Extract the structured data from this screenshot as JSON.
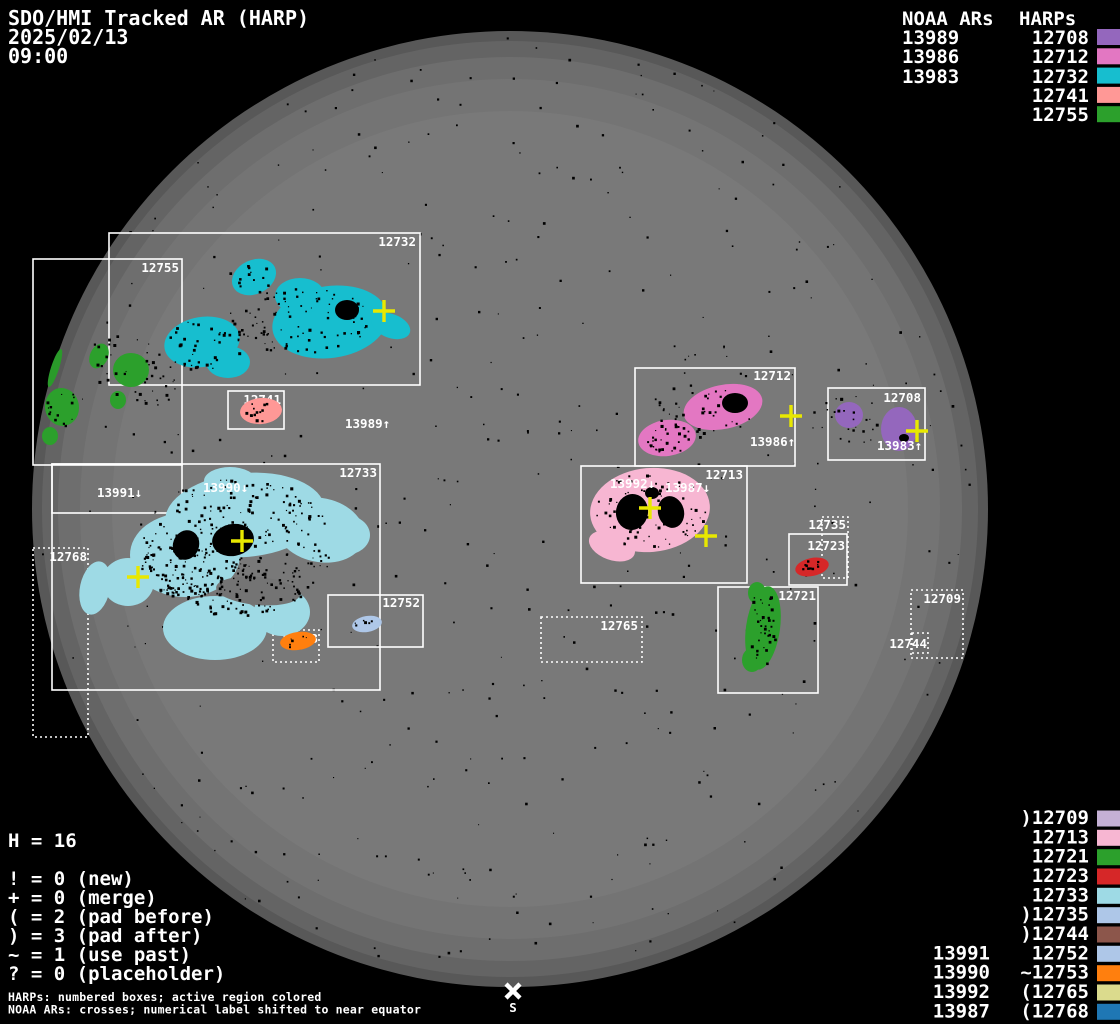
{
  "title": {
    "app": "SDO/HMI Tracked AR (HARP)",
    "date": "2025/02/13",
    "time": "09:00"
  },
  "colors": {
    "background": "#000000",
    "disk": "#757575",
    "yellow": "#e8e800",
    "white": "#ffffff"
  },
  "palette": {
    "12708": "#9467bd",
    "12712": "#e377c2",
    "12732": "#17becf",
    "12741": "#ff9896",
    "12755": "#2ca02c",
    "12709": "#c5b0d5",
    "12713": "#f7b6d2",
    "12721": "#2ca02c",
    "12723": "#d62728",
    "12733": "#9edae5",
    "12735": "#aec7e8",
    "12744": "#8c564b",
    "12752": "#aec7e8",
    "12753": "#ff7f0e",
    "12765": "#dbdb8d",
    "12768": "#1f77b4",
    "limb_green": "#2a9a2a"
  },
  "top_right": {
    "noaa_header": "NOAA ARs",
    "harps_header": "HARPs",
    "noaa": [
      "13989",
      "13986",
      "13983"
    ],
    "harps": [
      "12708",
      "12712",
      "12732",
      "12741",
      "12755"
    ]
  },
  "bottom_right": {
    "harps": [
      ")12709",
      "12713",
      "12721",
      "12723",
      "12733",
      ")12735",
      ")12744",
      "12752",
      "~12753",
      "(12765",
      "(12768"
    ],
    "noaa": [
      "13991",
      "13990",
      "13992",
      "13987"
    ]
  },
  "stats": {
    "h_count": "H = 16",
    "flags": [
      "! = 0 (new)",
      "+ = 0 (merge)",
      "( = 2 (pad before)",
      ") = 3 (pad after)",
      "~ = 1 (use past)",
      "? = 0 (placeholder)"
    ]
  },
  "footer": {
    "line1": "HARPs: numbered boxes; active region colored",
    "line2": "NOAA ARs: crosses; numerical label shifted to near equator"
  },
  "box_labels": {
    "12708": "12708",
    "12709": "12709",
    "12712": "12712",
    "12713": "12713",
    "12721": "12721",
    "12723": "12723",
    "12732": "12732",
    "12733": "12733",
    "12735": "12735",
    "12741": "12741",
    "12744": "12744",
    "12752": "12752",
    "12753": "12753",
    "12755": "12755",
    "12765": "12765",
    "12768": "12768"
  },
  "noaa_disk_labels": {
    "13989": "13989↑",
    "13986": "13986↑",
    "13983": "13983↑",
    "13991": "13991↓",
    "13990": "13990↓",
    "13992": "13992↓",
    "13987": "13987↓"
  },
  "south_marker": "S",
  "chart_data": {
    "type": "table",
    "title": "SDO/HMI Tracked AR (HARP) 2025/02/13 09:00",
    "harp_total": 16,
    "flag_counts": {
      "new": 0,
      "merge": 0,
      "pad_before": 2,
      "pad_after": 3,
      "use_past": 1,
      "placeholder": 0
    },
    "columns": [
      "HARP",
      "flag",
      "color",
      "NOAA_AR"
    ],
    "rows": [
      [
        "12708",
        "",
        "#9467bd",
        "13983"
      ],
      [
        "12712",
        "",
        "#e377c2",
        "13986"
      ],
      [
        "12732",
        "",
        "#17becf",
        "13989"
      ],
      [
        "12741",
        "",
        "#ff9896",
        ""
      ],
      [
        "12755",
        "",
        "#2ca02c",
        ""
      ],
      [
        "12709",
        ")",
        "#c5b0d5",
        ""
      ],
      [
        "12713",
        "",
        "#f7b6d2",
        "13992, 13987"
      ],
      [
        "12721",
        "",
        "#2ca02c",
        ""
      ],
      [
        "12723",
        "",
        "#d62728",
        ""
      ],
      [
        "12733",
        "",
        "#9edae5",
        "13991, 13990"
      ],
      [
        "12735",
        ")",
        "#aec7e8",
        ""
      ],
      [
        "12744",
        ")",
        "#8c564b",
        ""
      ],
      [
        "12752",
        "",
        "#aec7e8",
        "13991"
      ],
      [
        "12753",
        "~",
        "#ff7f0e",
        "13990"
      ],
      [
        "12765",
        "(",
        "#dbdb8d",
        "13992"
      ],
      [
        "12768",
        "(",
        "#1f77b4",
        "13987"
      ]
    ]
  }
}
